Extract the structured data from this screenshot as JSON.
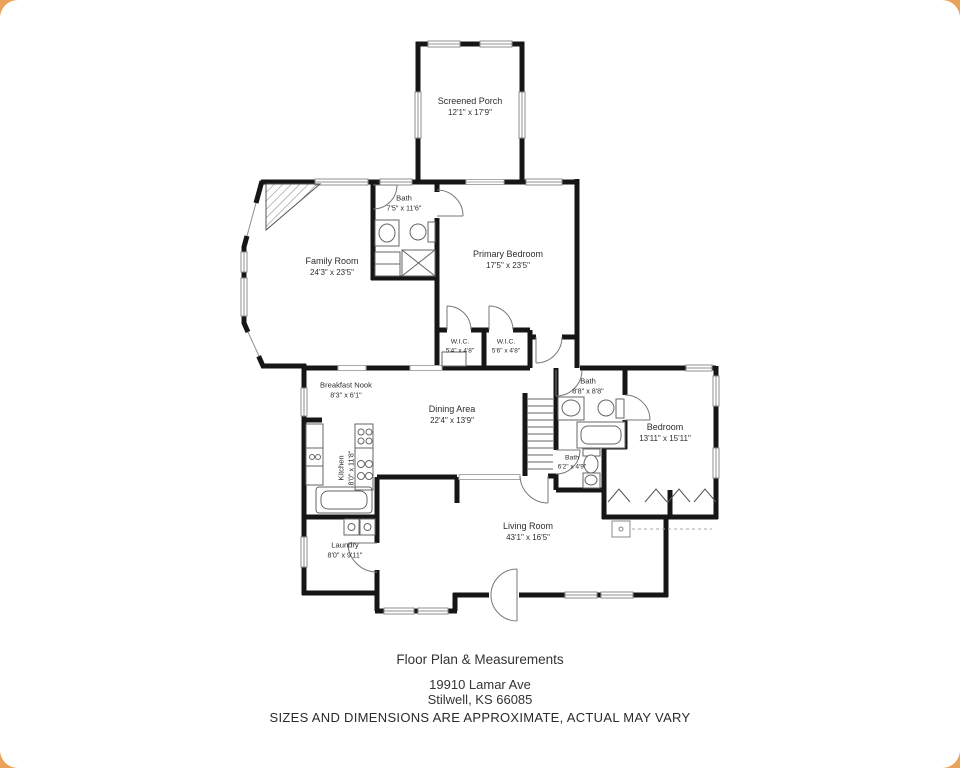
{
  "plan": {
    "rooms": [
      {
        "id": "screened-porch",
        "name": "Screened Porch",
        "dims": "12'1\" x 17'9\""
      },
      {
        "id": "family-room",
        "name": "Family Room",
        "dims": "24'3\" x 23'5\""
      },
      {
        "id": "bath-primary",
        "name": "Bath",
        "dims": "7'5\" x 11'6\""
      },
      {
        "id": "primary-bedroom",
        "name": "Primary Bedroom",
        "dims": "17'5\" x 23'5\""
      },
      {
        "id": "wic-left",
        "name": "W.I.C.",
        "dims": "5'4\" x 4'8\""
      },
      {
        "id": "wic-right",
        "name": "W.I.C.",
        "dims": "5'6\" x 4'8\""
      },
      {
        "id": "breakfast-nook",
        "name": "Breakfast Nook",
        "dims": "8'3\" x 6'1\""
      },
      {
        "id": "dining-area",
        "name": "Dining Area",
        "dims": "22'4\" x 13'9\""
      },
      {
        "id": "bath-hall",
        "name": "Bath",
        "dims": "8'8\" x 8'8\""
      },
      {
        "id": "bedroom",
        "name": "Bedroom",
        "dims": "13'11\" x 15'11\""
      },
      {
        "id": "kitchen",
        "name": "Kitchen",
        "dims": "8'0\" x 11'8\""
      },
      {
        "id": "bath-half",
        "name": "Bath",
        "dims": "6'2\" x 4'9\""
      },
      {
        "id": "living-room",
        "name": "Living Room",
        "dims": "43'1\" x 16'5\""
      },
      {
        "id": "laundry",
        "name": "Laundry",
        "dims": "8'0\" x 9'11\""
      }
    ]
  },
  "footer": {
    "title": "Floor Plan & Measurements",
    "address_line1": "19910 Lamar Ave",
    "address_line2": "Stilwell, KS 66085",
    "disclaimer": "SIZES AND DIMENSIONS ARE APPROXIMATE, ACTUAL MAY VARY"
  },
  "colors": {
    "wall": "#161616",
    "window_line": "#8f8f8f",
    "fixture_line": "#666666",
    "label_text": "#2d2d2d",
    "frame": "#e9a25a",
    "background": "#ffffff"
  }
}
